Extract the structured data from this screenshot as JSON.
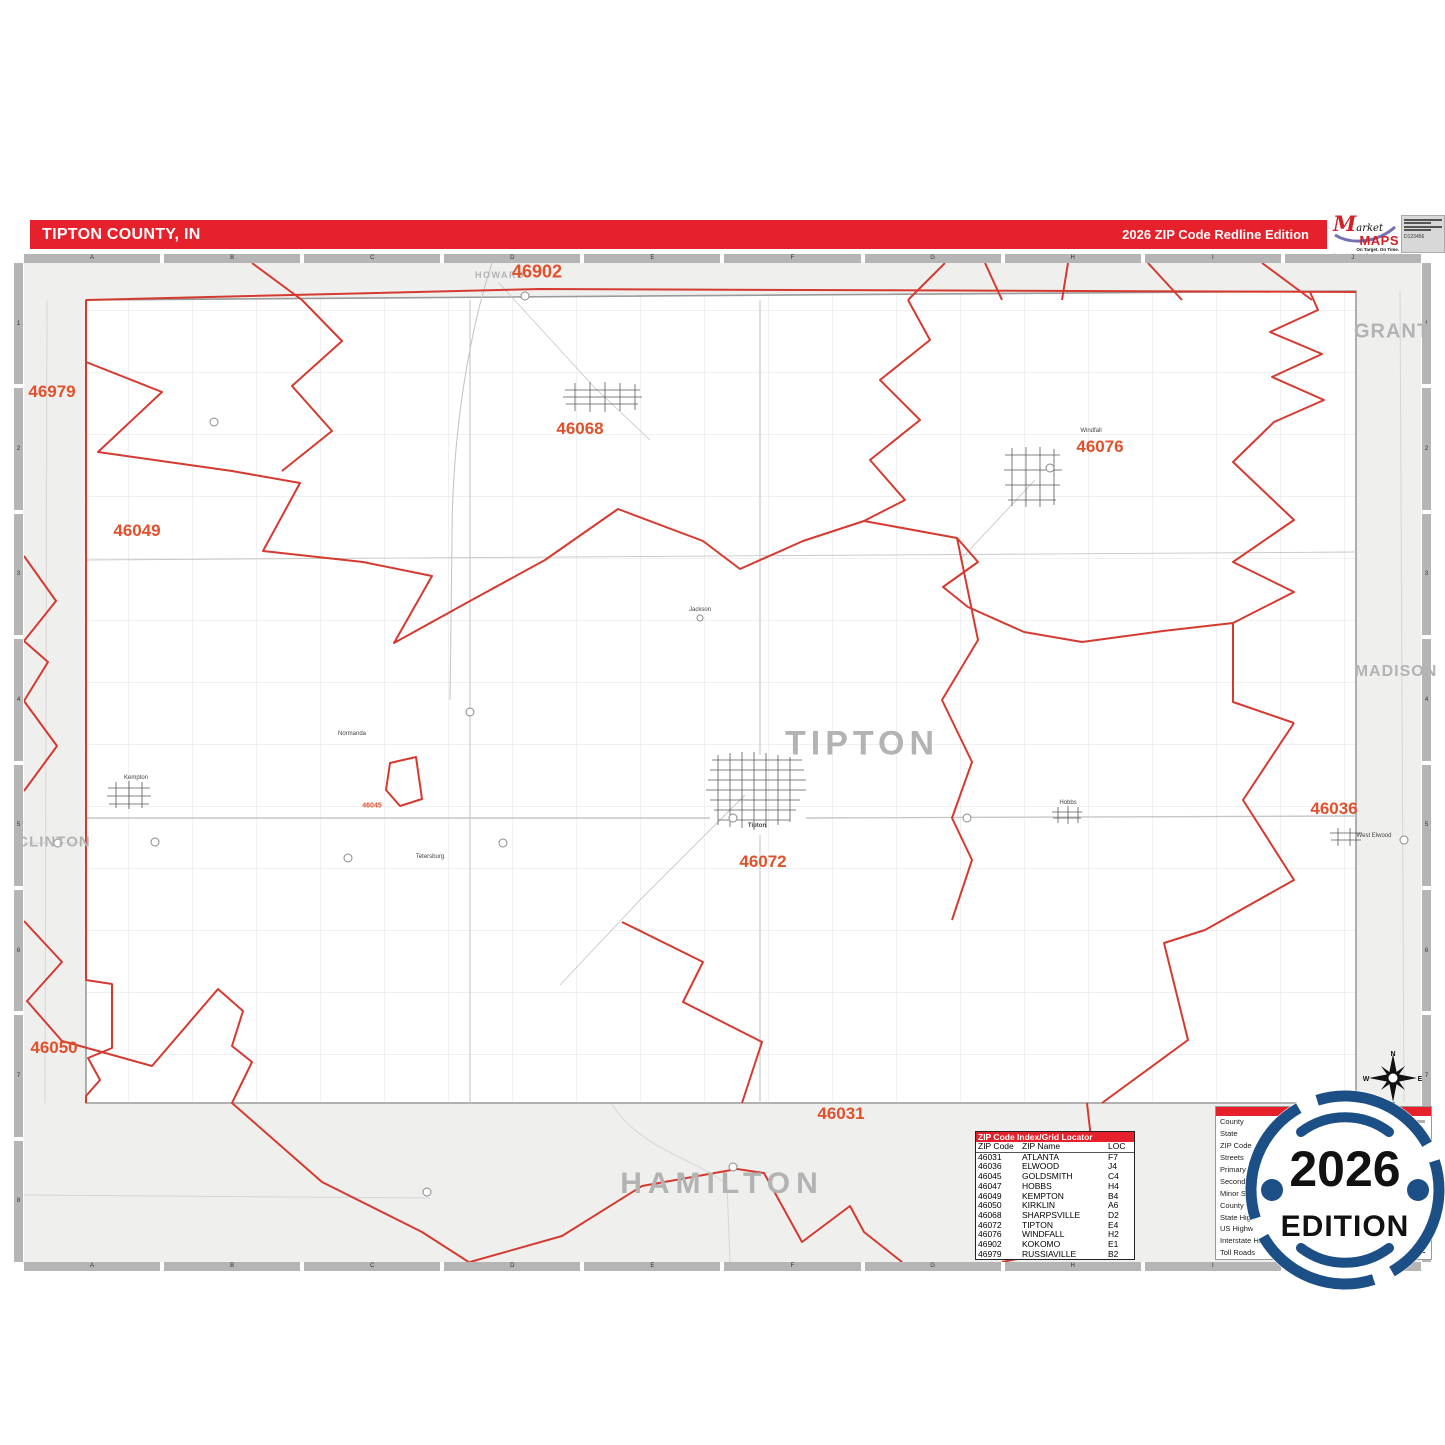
{
  "header": {
    "title": "TIPTON COUNTY, IN",
    "edition": "2026 ZIP Code Redline Edition"
  },
  "logo": {
    "market_m": "M",
    "market_rest": "arket",
    "maps": "MAPS",
    "tagline": "On Target.  On Time.",
    "subline": "America's Leading Source of Business Maps",
    "code": "D123456"
  },
  "rulers": {
    "cols": [
      "A",
      "B",
      "C",
      "D",
      "E",
      "F",
      "G",
      "H",
      "I",
      "J"
    ],
    "rows": [
      "1",
      "2",
      "3",
      "4",
      "5",
      "6",
      "7",
      "8"
    ]
  },
  "map": {
    "county_labels": [
      "HOWARD",
      "GRANT",
      "MADISON",
      "CLINTON",
      "HAMILTON",
      "TIPTON"
    ],
    "zip_labels": [
      "46902",
      "46979",
      "46049",
      "46068",
      "46076",
      "46036",
      "46072",
      "46050",
      "46031",
      "46045"
    ],
    "town_labels": [
      "Kempton",
      "Windfall",
      "Tipton",
      "Hobbs",
      "West Elwood",
      "Tetersburg",
      "Normanda",
      "Jackson"
    ]
  },
  "zip_index": {
    "title": "ZIP Code Index/Grid Locator",
    "columns": [
      "ZIP Code",
      "ZIP Name",
      "LOC"
    ],
    "rows": [
      [
        "46031",
        "ATLANTA",
        "F7"
      ],
      [
        "46036",
        "ELWOOD",
        "J4"
      ],
      [
        "46045",
        "GOLDSMITH",
        "C4"
      ],
      [
        "46047",
        "HOBBS",
        "H4"
      ],
      [
        "46049",
        "KEMPTON",
        "B4"
      ],
      [
        "46050",
        "KIRKLIN",
        "A6"
      ],
      [
        "46068",
        "SHARPSVILLE",
        "D2"
      ],
      [
        "46072",
        "TIPTON",
        "E4"
      ],
      [
        "46076",
        "WINDFALL",
        "H2"
      ],
      [
        "46902",
        "KOKOMO",
        "E1"
      ],
      [
        "46979",
        "RUSSIAVILLE",
        "B2"
      ]
    ]
  },
  "legend": {
    "items": [
      "County",
      "State",
      "ZIP Code",
      "Streets",
      "Primary Streets",
      "Secondary Streets",
      "Minor Streets",
      "County Highways",
      "State Highways",
      "US Highways",
      "Interstate Highways",
      "Toll Roads"
    ]
  },
  "badge": {
    "year": "2026",
    "edition": "EDITION"
  },
  "compass": {
    "n": "N",
    "e": "E",
    "w": "W",
    "s": "S"
  },
  "colors": {
    "header_red": "#e6212b",
    "zip_red_line": "#d53a30",
    "zip_label": "#e0512c",
    "badge_blue": "#1d4f87",
    "outside_gray": "#eff0ee"
  }
}
